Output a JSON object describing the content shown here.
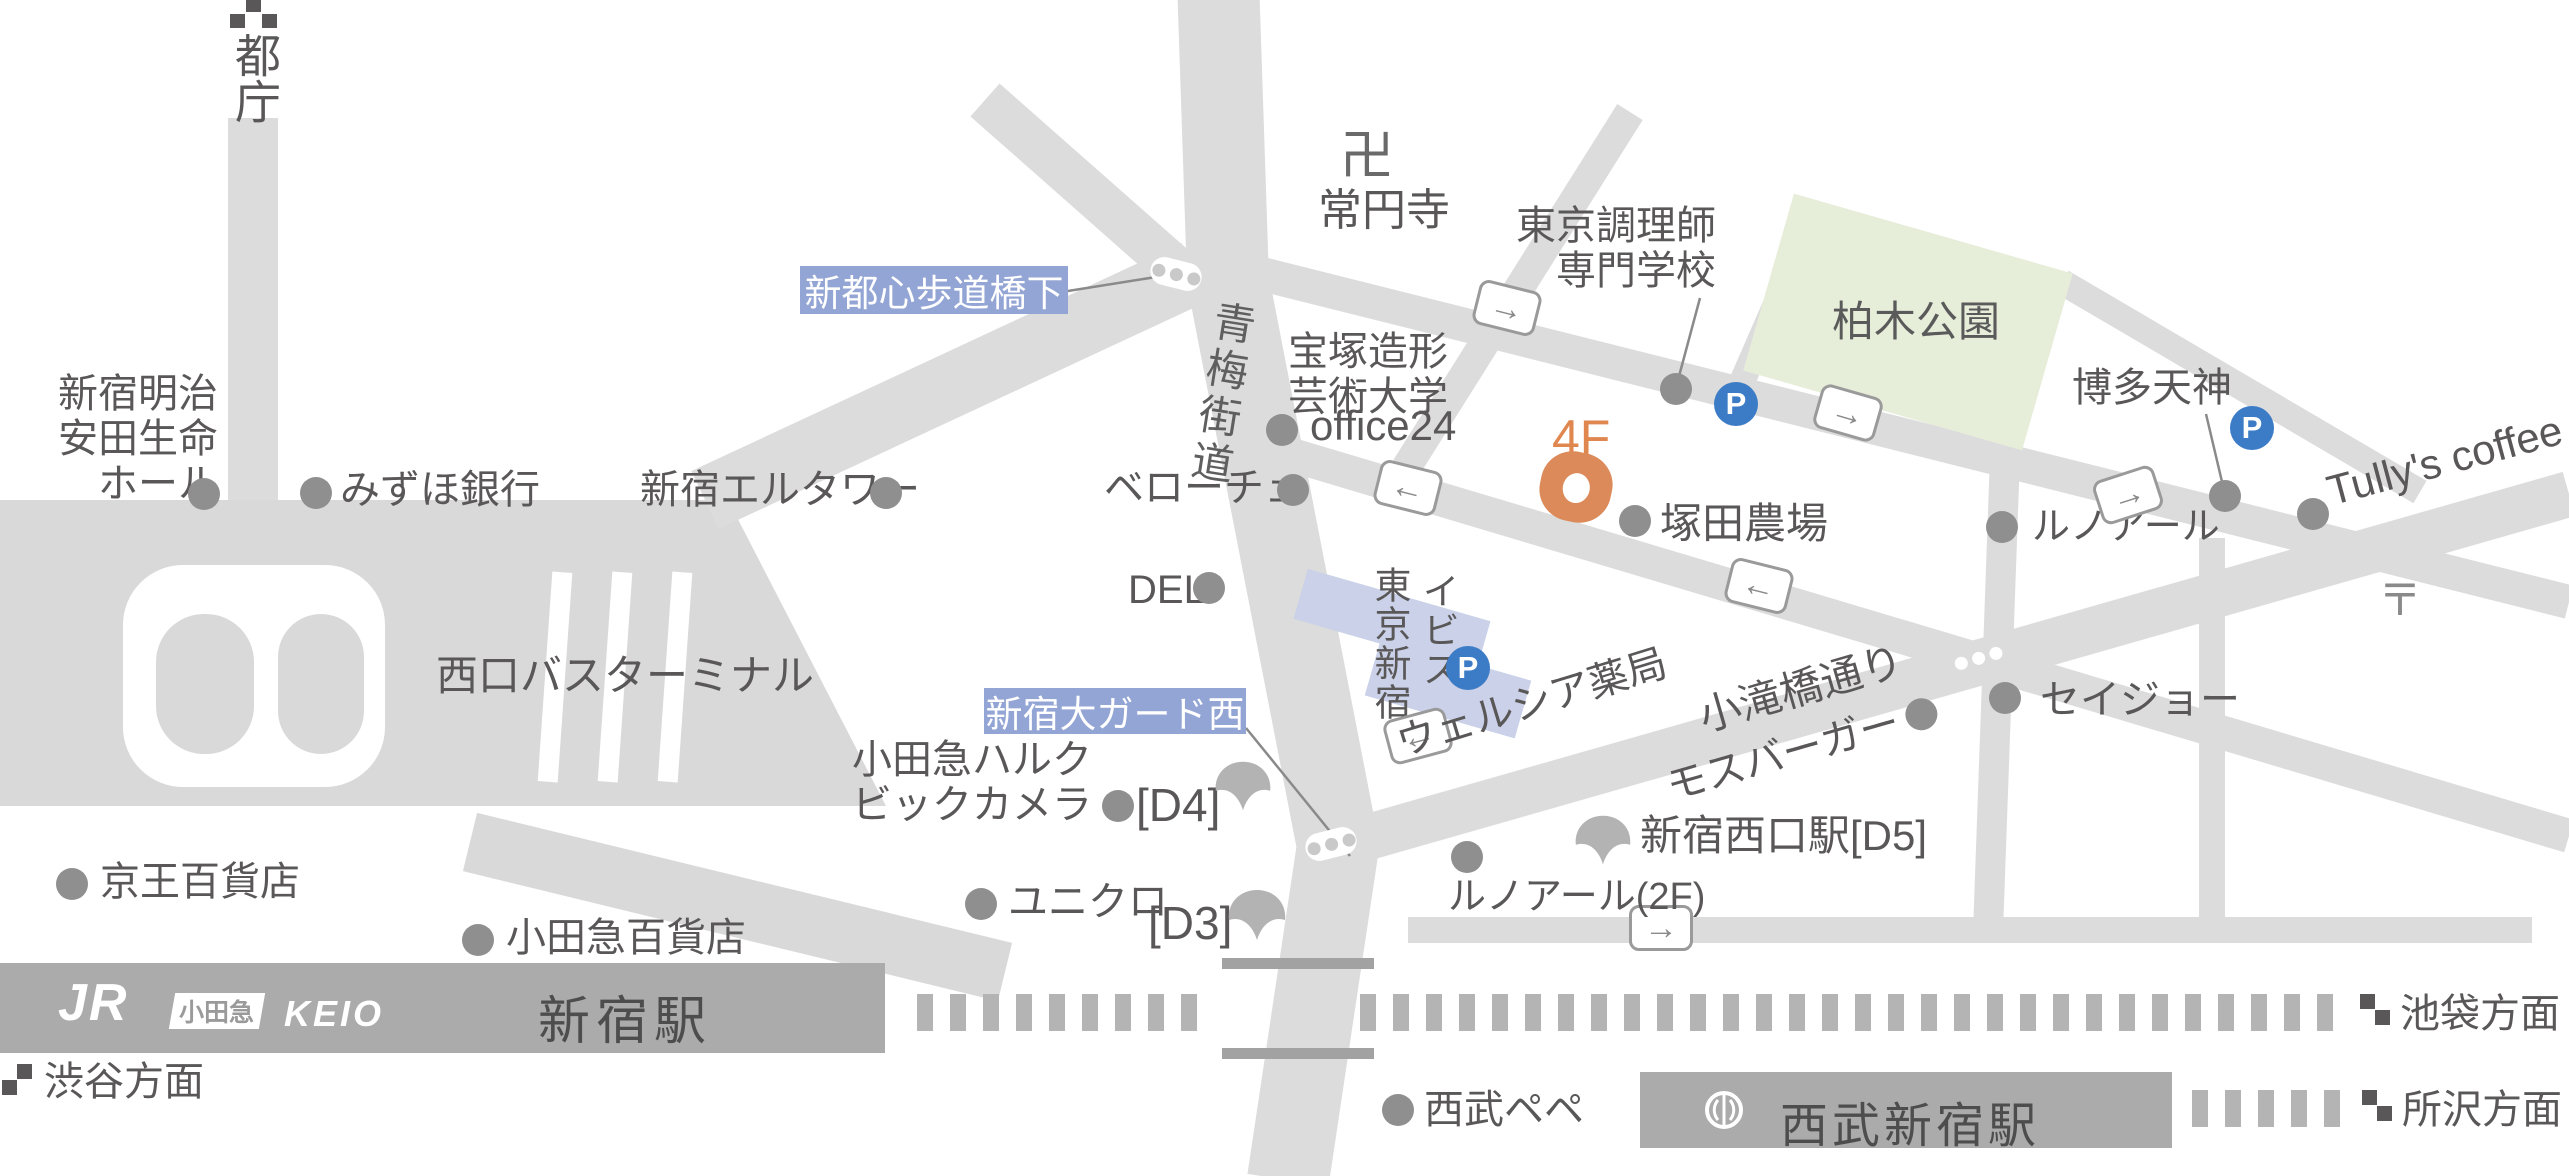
{
  "title": "新宿駅周辺アクセスマップ",
  "destination": {
    "floor_label": "4F"
  },
  "signs": {
    "shintoshin_bridge": "新都心歩道橋下",
    "oguard_west": "新宿大ガード西"
  },
  "roads": {
    "ome_kaido": "青梅街道",
    "kotakibashi_dori": "小滝橋通り"
  },
  "landmarks": {
    "tocho": "都庁",
    "manji": "卍",
    "joenji": "常円寺",
    "chorishi_line1": "東京調理師",
    "chorishi_line2": "専門学校",
    "kashiwagi_park": "柏木公園",
    "hakata_tenjin": "博多天神",
    "tullys": "Tully's coffee",
    "renoir": "ルノアール",
    "takarazuka_line1": "宝塚造形",
    "takarazuka_line2": "芸術大学",
    "office24": "office24",
    "veloce": "ベローチェ",
    "deli": "DELI",
    "tsukada_nojo": "塚田農場",
    "seijo": "セイジョー",
    "wellcia": "ウェルシア薬局",
    "mos_burger": "モスバーガー",
    "building_col_left": "東京新宿",
    "building_col_right": "イビス",
    "odakyu_halc": "小田急ハルク",
    "bic_camera": "ビックカメラ",
    "exit_d4": "[D4]",
    "exit_d3": "[D3]",
    "uniqlo": "ユニクロ",
    "renoir_2f": "ルノアール(2F)",
    "nishiguchi_station_d5": "新宿西口駅[D5]",
    "bus_terminal": "西口バスターミナル",
    "meiji_line1": "新宿明治",
    "meiji_line2": "安田生命",
    "meiji_line3": "ホール",
    "mizuho": "みずほ銀行",
    "el_tower": "新宿エルタワー",
    "keio_dept": "京王百貨店",
    "odakyu_dept": "小田急百貨店",
    "seibu_pepe": "西武ペペ",
    "post_mark": "〒",
    "parking": "P"
  },
  "stations": {
    "shinjuku": "新宿駅",
    "seibu_shinjuku": "西武新宿駅",
    "jr_logo": "JR",
    "odakyu_logo": "小田急",
    "keio_logo": "KEIO"
  },
  "directions": {
    "shibuya": "渋谷方面",
    "ikebukuro": "池袋方面",
    "tokorozawa": "所沢方面"
  },
  "colors": {
    "road": "#dcdcdc",
    "block": "#d9d9d9",
    "station_bar": "#ababab",
    "park_green": "#e6eeda",
    "sign_blue": "#93a5d4",
    "building_blue": "#cad1e8",
    "parking_blue": "#3c7cc6",
    "marker_orange": "#dc8a59",
    "text_gray": "#595757"
  }
}
